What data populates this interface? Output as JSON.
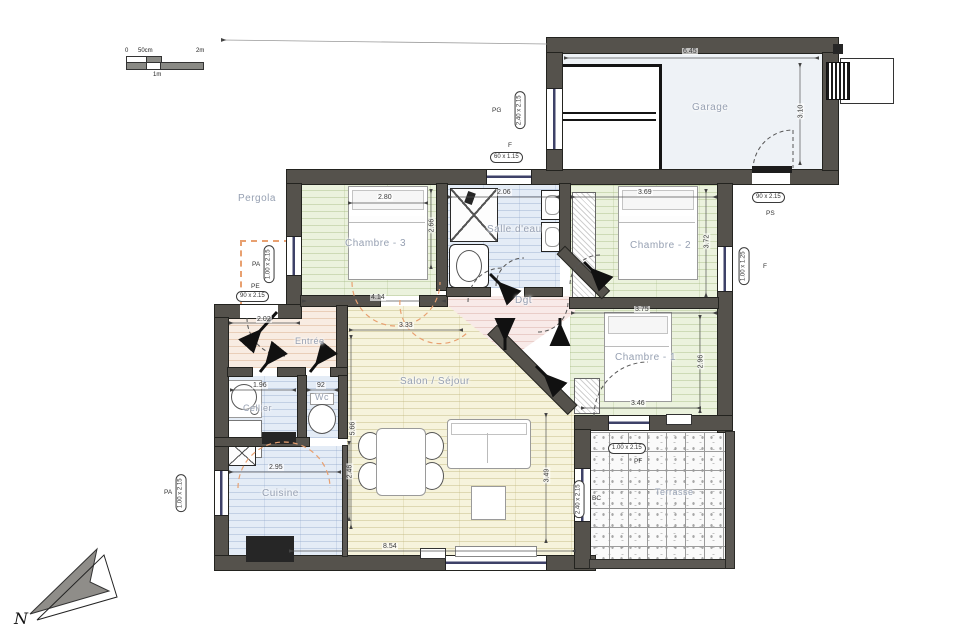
{
  "scalebar": {
    "zero": "0",
    "fifty": "50cm",
    "one": "1m",
    "two": "2m"
  },
  "north": {
    "label": "N"
  },
  "rooms": {
    "garage": {
      "label": "Garage",
      "w": "6.45",
      "h": "3.10"
    },
    "pergola": {
      "label": "Pergola"
    },
    "chambre3": {
      "label": "Chambre - 3",
      "bed": "2.80",
      "h": "2.66",
      "w": "4.14"
    },
    "salle_eau": {
      "label": "Salle d'eau",
      "w": "2.06"
    },
    "chambre2": {
      "label": "Chambre - 2",
      "w": "3.69",
      "h": "3.72"
    },
    "chambre1": {
      "label": "Chambre - 1",
      "w": "3.75",
      "h": "2.96",
      "door": "3.46"
    },
    "dgt": {
      "label": "Dgt"
    },
    "entree": {
      "label": "Entrée",
      "w": "2.02"
    },
    "cellier": {
      "label": "Cellier",
      "w": "1.96"
    },
    "wc": {
      "label": "Wc",
      "w": "92"
    },
    "salon": {
      "label": "Salon / Séjour",
      "top": "3.33",
      "left": "5.66",
      "bottom": "8.54",
      "right": "3.49"
    },
    "cuisine": {
      "label": "Cuisine",
      "w": "2.95",
      "h": "2.46"
    },
    "terrasse": {
      "label": "Terrasse"
    }
  },
  "openings": {
    "pa_pergola": {
      "code": "PA",
      "size": "1.00 x 2.15"
    },
    "pe_entree": {
      "code": "PE",
      "size": "90 x 2.15"
    },
    "pg_garage": {
      "code": "PG",
      "size": "2.40 x 2.15"
    },
    "f_top": {
      "code": "F",
      "size": "60 x 1.15"
    },
    "ps_right": {
      "code": "PS",
      "size": "90 x 2.15"
    },
    "f_right": {
      "code": "F",
      "size": "1.00 x 1.25"
    },
    "pf_terrasse": {
      "code": "PF",
      "size": "1.00 x 2.15"
    },
    "bc_salon": {
      "code": "BC",
      "size": "2.40 x 2.15"
    },
    "pa_cuisine": {
      "code": "PA",
      "size": "1.00 x 2.15"
    }
  },
  "colors": {
    "wall": "#55524c",
    "accent_dash": "#e8a070"
  }
}
